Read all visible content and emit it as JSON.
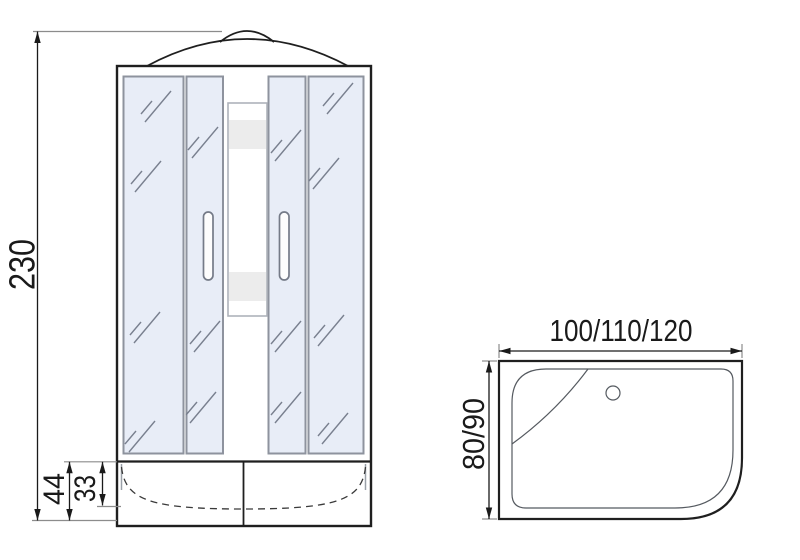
{
  "front_view": {
    "dim_height": "230",
    "dim_base_height": "44",
    "dim_tray_depth": "33"
  },
  "top_view": {
    "dim_width": "100/110/120",
    "dim_depth": "80/90"
  },
  "colors": {
    "outline": "#1f1f1f",
    "glass_fill": "#e8edf7",
    "glass_border": "#8e939e",
    "panel_band": "#ececec",
    "dim_text": "#1a1a1a"
  }
}
